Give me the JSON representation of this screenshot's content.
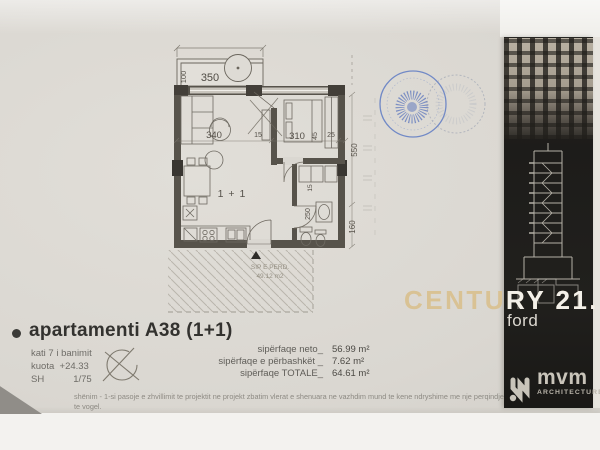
{
  "document": {
    "title": "apartamenti A38 (1+1)",
    "info_lines": "kati 7 i banimit\nkuota  +24.33\nSH           1/75",
    "areas": [
      {
        "label": "sipërfaqe neto_",
        "value": "56.99 m²"
      },
      {
        "label": "sipërfaqe e përbashkët _",
        "value": "7.62 m²"
      },
      {
        "label": "sipërfaqe TOTALE_",
        "value": "64.61 m²"
      }
    ],
    "note1": "shënim - 1-si pasoje e zhvillimit te projektit ne projekt zbatim vlerat e shenuara ne vazhdim mund te kene ndryshime me nje perqindje te vogel.",
    "note2": "2- ne siperfaqen e perbashket te apartamenteve jane perfshire shkalla e banimit, depo dhe kabina elektrike"
  },
  "floorplan": {
    "room_label": "1 + 1",
    "hatch_label1": "SIP E PERD.",
    "hatch_label2": "49.12 m2",
    "dims": {
      "balcony_depth": "100",
      "balcony_width": "350",
      "living_width": "340",
      "partition": "15",
      "bedroom_width": "310",
      "niche": "45",
      "ext_wall": "25",
      "height_upper": "550",
      "height_lower": "160",
      "bath_depth": "250",
      "bath_wall": "15",
      "offset": "40"
    }
  },
  "branding": {
    "watermark": "CENTURY 21.",
    "watermark_sub": "ford",
    "logo_text": "mvm",
    "logo_sub": "ARCHITECTURE"
  },
  "colors": {
    "paper": "#dad7d1",
    "strip_bg": "#1d1c1a",
    "watermark_tan": "#d9c294",
    "watermark_white": "#f3f0e9",
    "stamp_blue": "#4a66bd",
    "plan_line": "#5b564e"
  }
}
